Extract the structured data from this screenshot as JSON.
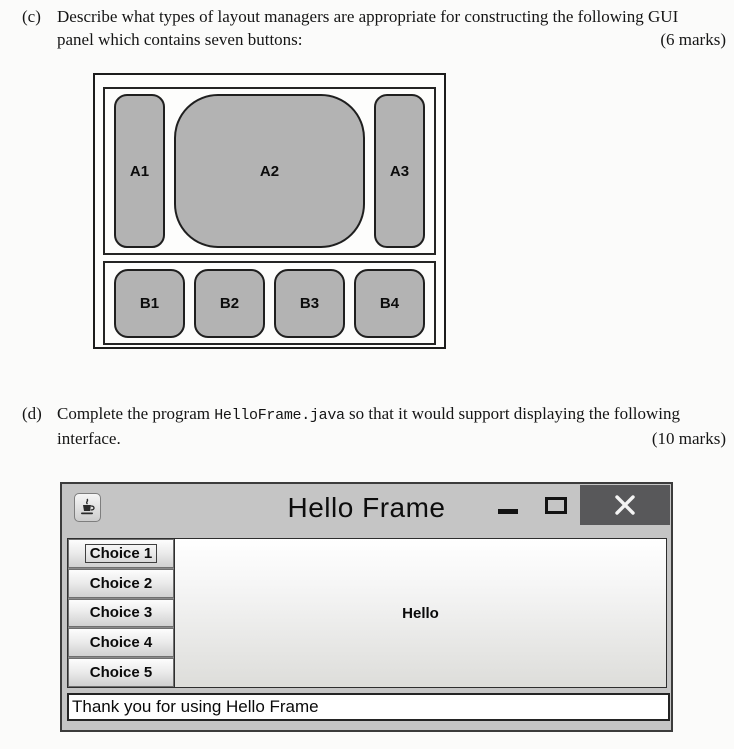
{
  "questions": {
    "c": {
      "label": "(c)",
      "line1": "Describe what types of layout managers are appropriate for constructing the following GUI",
      "line2": "panel which contains seven buttons:",
      "marks": "(6 marks)"
    },
    "d": {
      "label": "(d)",
      "line1_pre": "Complete the program ",
      "line1_code": "HelloFrame.java",
      "line1_post": " so that it would support displaying the following",
      "line2": "interface.",
      "marks": "(10 marks)"
    }
  },
  "diagram": {
    "description": "GUI panel with seven buttons in two sub-panels",
    "top_buttons": [
      "A1",
      "A2",
      "A3"
    ],
    "bottom_buttons": [
      "B1",
      "B2",
      "B3",
      "B4"
    ],
    "button_fill_color": "#b3b3b3"
  },
  "hello_frame": {
    "title": "Hello Frame",
    "window_icon": "java-coffee-cup",
    "choice_buttons": [
      "Choice 1",
      "Choice 2",
      "Choice 3",
      "Choice 4",
      "Choice 5"
    ],
    "focused_button": "Choice 1",
    "center_label": "Hello",
    "status_text": "Thank you for using Hello Frame",
    "colors": {
      "titlebar": "#c5c5c5",
      "close_button": "#58585a",
      "content_panel_top": "#ffffff",
      "content_panel_bottom": "#dddddd"
    }
  }
}
